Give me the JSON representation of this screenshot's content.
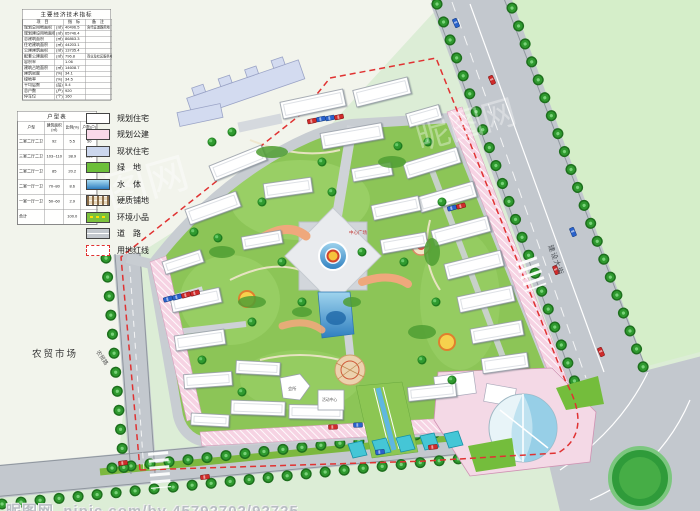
{
  "indicators": {
    "title": "主要经济技术指标",
    "headers": {
      "item": "项 目",
      "value": "指 标",
      "note": "备 注"
    },
    "rows": [
      {
        "label": "规划总用地面积",
        "unit": "(㎡)",
        "value": "40496.5",
        "note": "含代征道路用地"
      },
      {
        "label": "规划建设用地面积",
        "unit": "(㎡)",
        "value": "65746.4",
        "note": ""
      },
      {
        "label": "总建筑面积",
        "unit": "(㎡)",
        "value": "86863.3",
        "note": ""
      },
      {
        "label": "住宅建筑面积",
        "unit": "(㎡)",
        "value": "44203.1",
        "note": ""
      },
      {
        "label": "公建建筑面积",
        "unit": "(㎡)",
        "value": "13735.4",
        "note": ""
      },
      {
        "label": "配套公建面积",
        "unit": "(㎡)",
        "value": "796.8",
        "note": "商业及社区服务中心"
      },
      {
        "label": "容积率",
        "unit": "",
        "value": "1.06",
        "note": ""
      },
      {
        "label": "建筑占地面积",
        "unit": "(㎡)",
        "value": "14608.7",
        "note": ""
      },
      {
        "label": "建筑密度",
        "unit": "(%)",
        "value": "34.1",
        "note": ""
      },
      {
        "label": "绿地率",
        "unit": "(%)",
        "value": "34.5",
        "note": ""
      },
      {
        "label": "平均层数",
        "unit": "(层)",
        "value": "5.4",
        "note": ""
      },
      {
        "label": "总户数",
        "unit": "(户)",
        "value": "920",
        "note": ""
      },
      {
        "label": "停车位",
        "unit": "(个)",
        "value": "160",
        "note": ""
      }
    ]
  },
  "unit_table": {
    "title": "户型表",
    "headers": [
      "户型",
      "建筑面积(㎡)",
      "比例(%)",
      "户数(户)"
    ],
    "rows": [
      [
        "二室二厅二卫",
        "92",
        "5.5",
        "50"
      ],
      [
        "三室二厅二卫",
        "103~110",
        "38.9",
        "358"
      ],
      [
        "二室二厅一卫",
        "85",
        "20.2",
        "182"
      ],
      [
        "二室一厅一卫",
        "70~80",
        "8.6",
        "56"
      ],
      [
        "一室一厅一卫",
        "50~60",
        "2.9",
        "15"
      ],
      [
        "合计",
        "",
        "100.0",
        "920"
      ]
    ]
  },
  "legend": {
    "items": [
      {
        "label": "规划住宅",
        "type": "residential"
      },
      {
        "label": "规划公建",
        "type": "public"
      },
      {
        "label": "现状住宅",
        "type": "existing"
      },
      {
        "label": "绿　地",
        "type": "green"
      },
      {
        "label": "水　体",
        "type": "water"
      },
      {
        "label": "硬质铺地",
        "type": "paving"
      },
      {
        "label": "环境小品",
        "type": "ornament"
      },
      {
        "label": "道　路",
        "type": "road"
      },
      {
        "label": "用地红线",
        "type": "redline"
      }
    ]
  },
  "map_labels": {
    "farmers_market": "农贸市场",
    "central_plaza": "中心广场",
    "clubhouse": "会所",
    "activity_center": "活动中心",
    "east_road": "建设大街",
    "west_road": "农贸路"
  },
  "watermark": {
    "center": "昵图网",
    "bottom": "昵图网_nipic.com/by 45792702/92725"
  },
  "colors": {
    "green_space": "#8cc557",
    "water": "#4a9fd8",
    "planned_public": "#f7d6e6",
    "existing_residential": "#ccd7ee",
    "road": "#c3c8ce",
    "red_line": "#e03232",
    "tree": "#2f9a2f"
  }
}
